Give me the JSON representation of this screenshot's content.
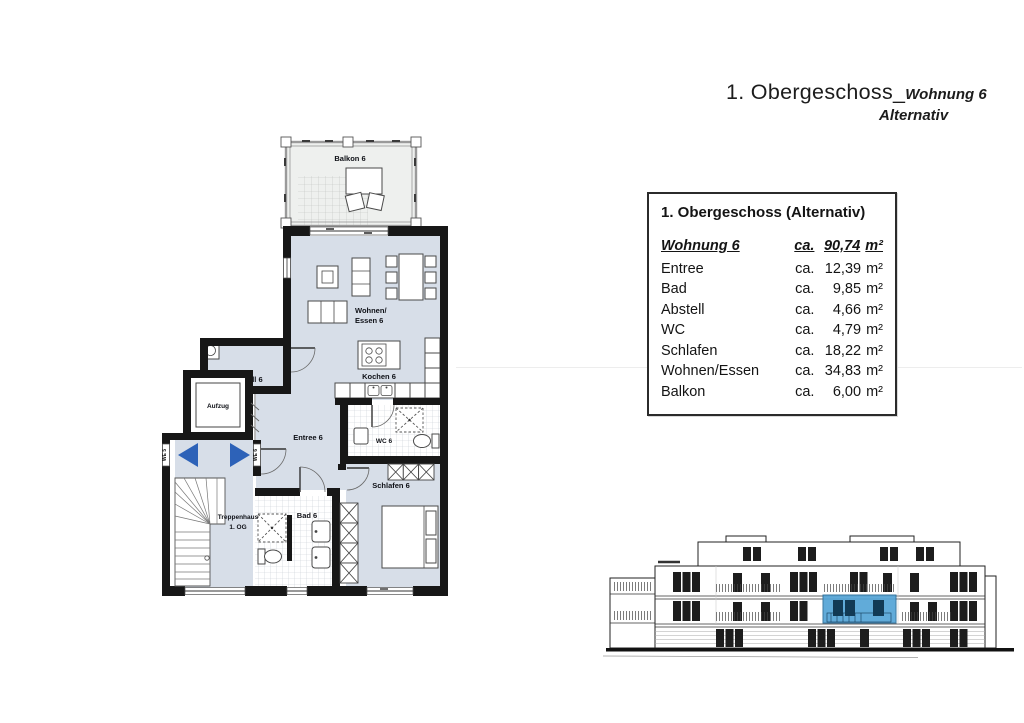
{
  "title": {
    "main": "1. Obergeschoss_",
    "unit": "Wohnung 6",
    "variant": "Alternativ"
  },
  "area_table": {
    "header": "1. Obergeschoss (Alternativ)",
    "unit_row": {
      "label": "Wohnung 6",
      "ca": "ca.",
      "num": "90,74",
      "unit": "m²"
    },
    "rows": [
      {
        "label": "Entree",
        "ca": "ca.",
        "num": "12,39",
        "unit": "m²"
      },
      {
        "label": "Bad",
        "ca": "ca.",
        "num": "9,85",
        "unit": "m²"
      },
      {
        "label": "Abstell",
        "ca": "ca.",
        "num": "4,66",
        "unit": "m²"
      },
      {
        "label": "WC",
        "ca": "ca.",
        "num": "4,79",
        "unit": "m²"
      },
      {
        "label": "Schlafen",
        "ca": "ca.",
        "num": "18,22",
        "unit": "m²"
      },
      {
        "label": "Wohnen/Essen",
        "ca": "ca.",
        "num": "34,83",
        "unit": "m²"
      },
      {
        "label": "Balkon",
        "ca": "ca.",
        "num": "6,00",
        "unit": "m²"
      }
    ]
  },
  "plan": {
    "labels": {
      "balkon": "Balkon 6",
      "wohnen_line1": "Wohnen/",
      "wohnen_line2": "Essen 6",
      "kochen": "Kochen 6",
      "abstell": "Abstell 6",
      "aufzug": "Aufzug",
      "entree": "Entree 6",
      "wc": "WC 6",
      "bad": "Bad 6",
      "schlafen": "Schlafen 6",
      "treppenhaus_line1": "Treppenhaus",
      "treppenhaus_line2": "1. OG",
      "we5": "WE 5",
      "we6": "WE 6"
    }
  },
  "colors": {
    "room_fill": "#d7dee8",
    "balcony_fill": "#eef0ee",
    "wall": "#171717",
    "arrow_blue": "#2d62b8",
    "highlight_blue": "#54a4d6"
  }
}
